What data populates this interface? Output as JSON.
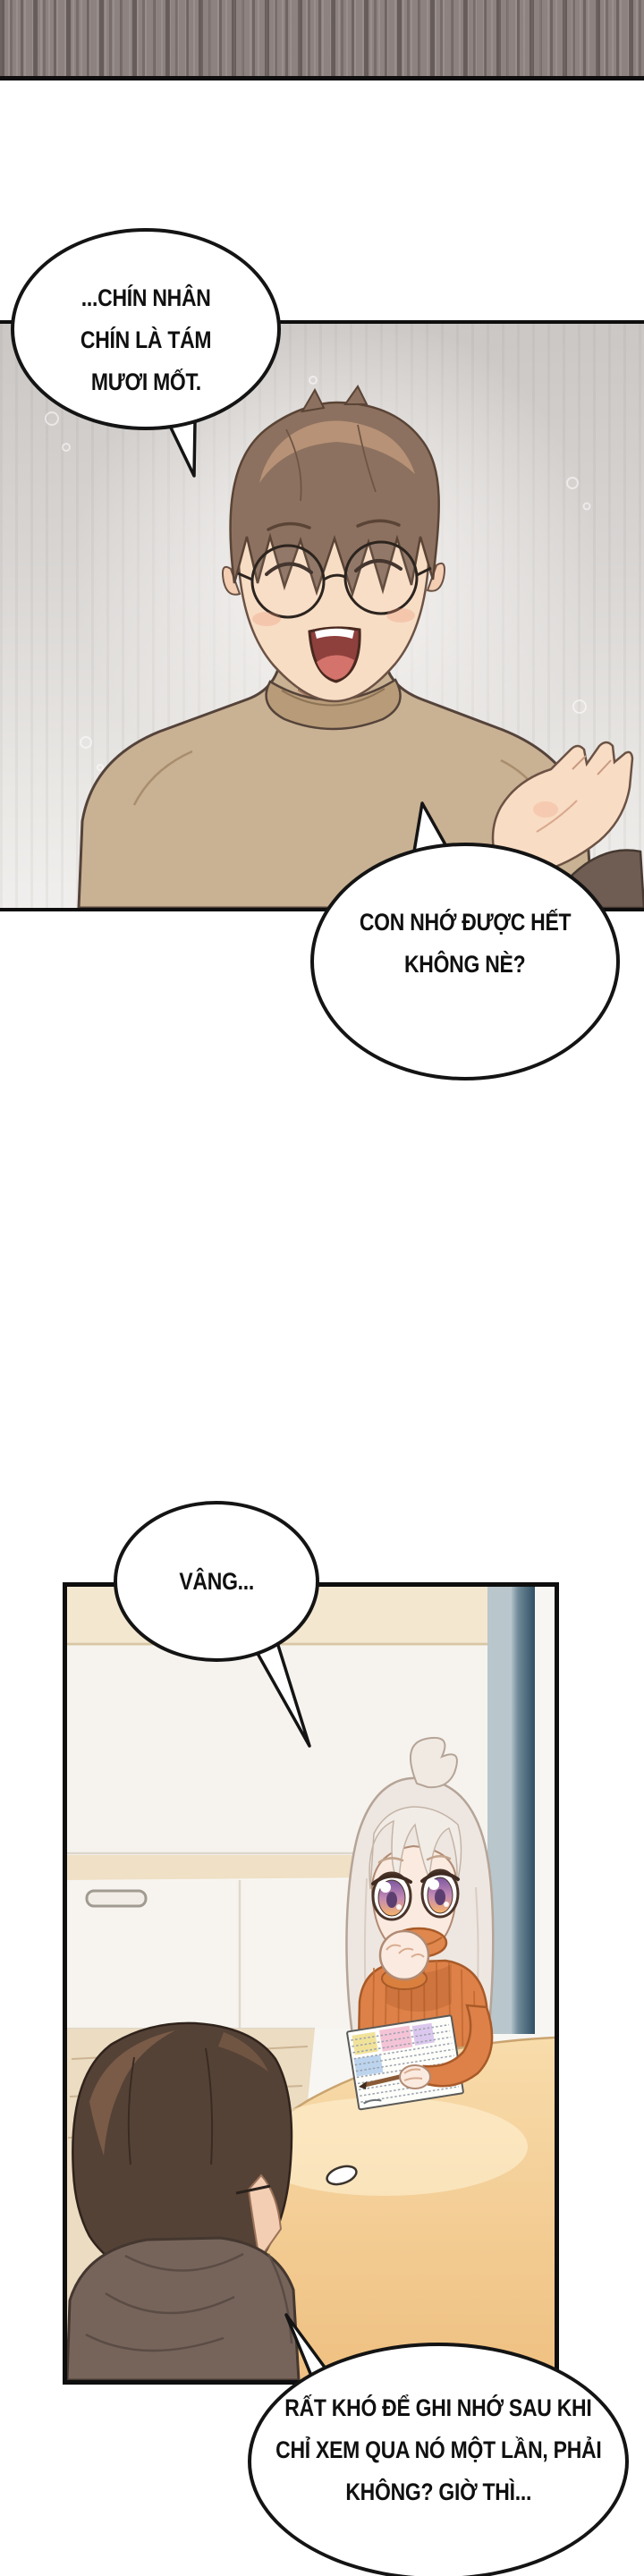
{
  "bubbles": {
    "b1": {
      "lines": [
        "...CHÍN NHÂN",
        "CHÍN LÀ TÁM",
        "MƯƠI MỐT."
      ]
    },
    "b2": {
      "lines": [
        "CON NHỚ ĐƯỢC HẾT",
        "KHÔNG NÈ?"
      ]
    },
    "b3": {
      "lines": [
        "VÂNG..."
      ]
    },
    "b4": {
      "lines": [
        "RẤT KHÓ ĐỂ GHI NHỚ SAU KHI",
        "CHỈ XEM QUA NÓ MỘT LẦN, PHẢI",
        "KHÔNG? GIỜ THÌ..."
      ]
    }
  },
  "palette": {
    "page_bg": "#ffffff",
    "panel_border": "#0e0e0e",
    "bubble_border": "#141414",
    "top_strip": "#8d8280",
    "dad_panel_bg_top": "#cbc7c5",
    "dad_panel_bg_bottom": "#f1efed",
    "dad_hair": "#8d7160",
    "dad_skin": "#f8ddc5",
    "dad_sweater": "#c9b193",
    "girl_hair": "#eee7e1",
    "girl_sweater": "#dd8148",
    "girl_eye_top": "#7c58a0",
    "girl_eye_bottom": "#f6b368",
    "table": "#f3cc94",
    "window_teal": "#2f5064",
    "counter_beige": "#f3e7d0",
    "boy_back_hair": "#554236",
    "boy_back_shirt": "#76645a"
  }
}
